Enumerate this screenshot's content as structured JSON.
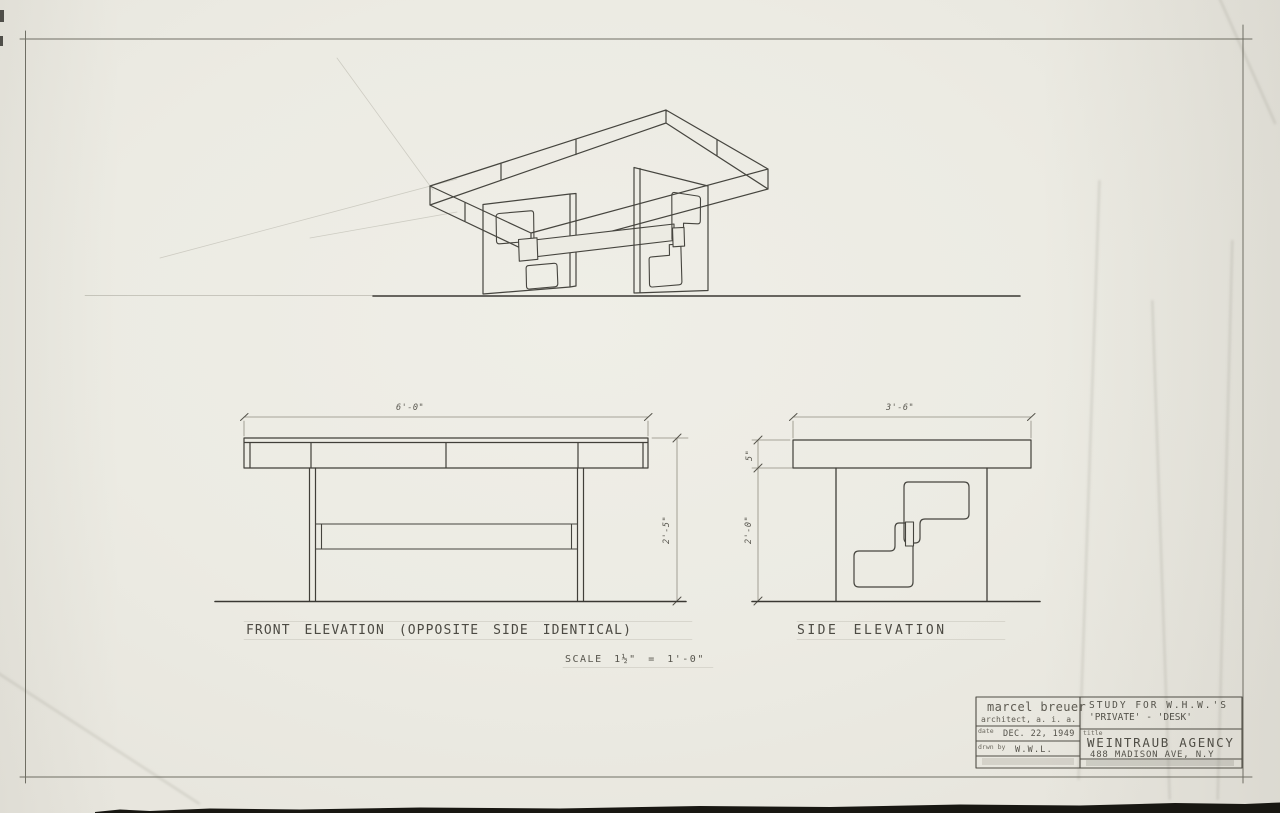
{
  "sheet": {
    "labels": {
      "front_elevation": "FRONT ELEVATION (OPPOSITE SIDE IDENTICAL)",
      "side_elevation": "SIDE ELEVATION",
      "scale_note": "SCALE 1½\" = 1'-0\""
    },
    "dimensions": {
      "front_width": "6'-0\"",
      "front_height": "2'-5\"",
      "side_width": "3'-6\"",
      "side_top_thickness": "5\"",
      "side_under_height": "2'-0\""
    },
    "title_block": {
      "architect_name": "marcel breuer",
      "architect_title": "architect, a. i. a.",
      "date_label": "date",
      "date_value": "DEC. 22, 1949",
      "drawn_by_label": "drwn by",
      "drawn_by_value": "W.W.L.",
      "study_line1": "STUDY FOR W.H.W.'S",
      "study_line2": "'PRIVATE' - 'DESK'",
      "title_label": "title",
      "client_name": "WEINTRAUB AGENCY",
      "client_address": "488 MADISON AVE, N.Y"
    },
    "colors": {
      "paper": "#ecebe3",
      "pencil": "#45443e",
      "photo_edge": "#181712"
    }
  }
}
